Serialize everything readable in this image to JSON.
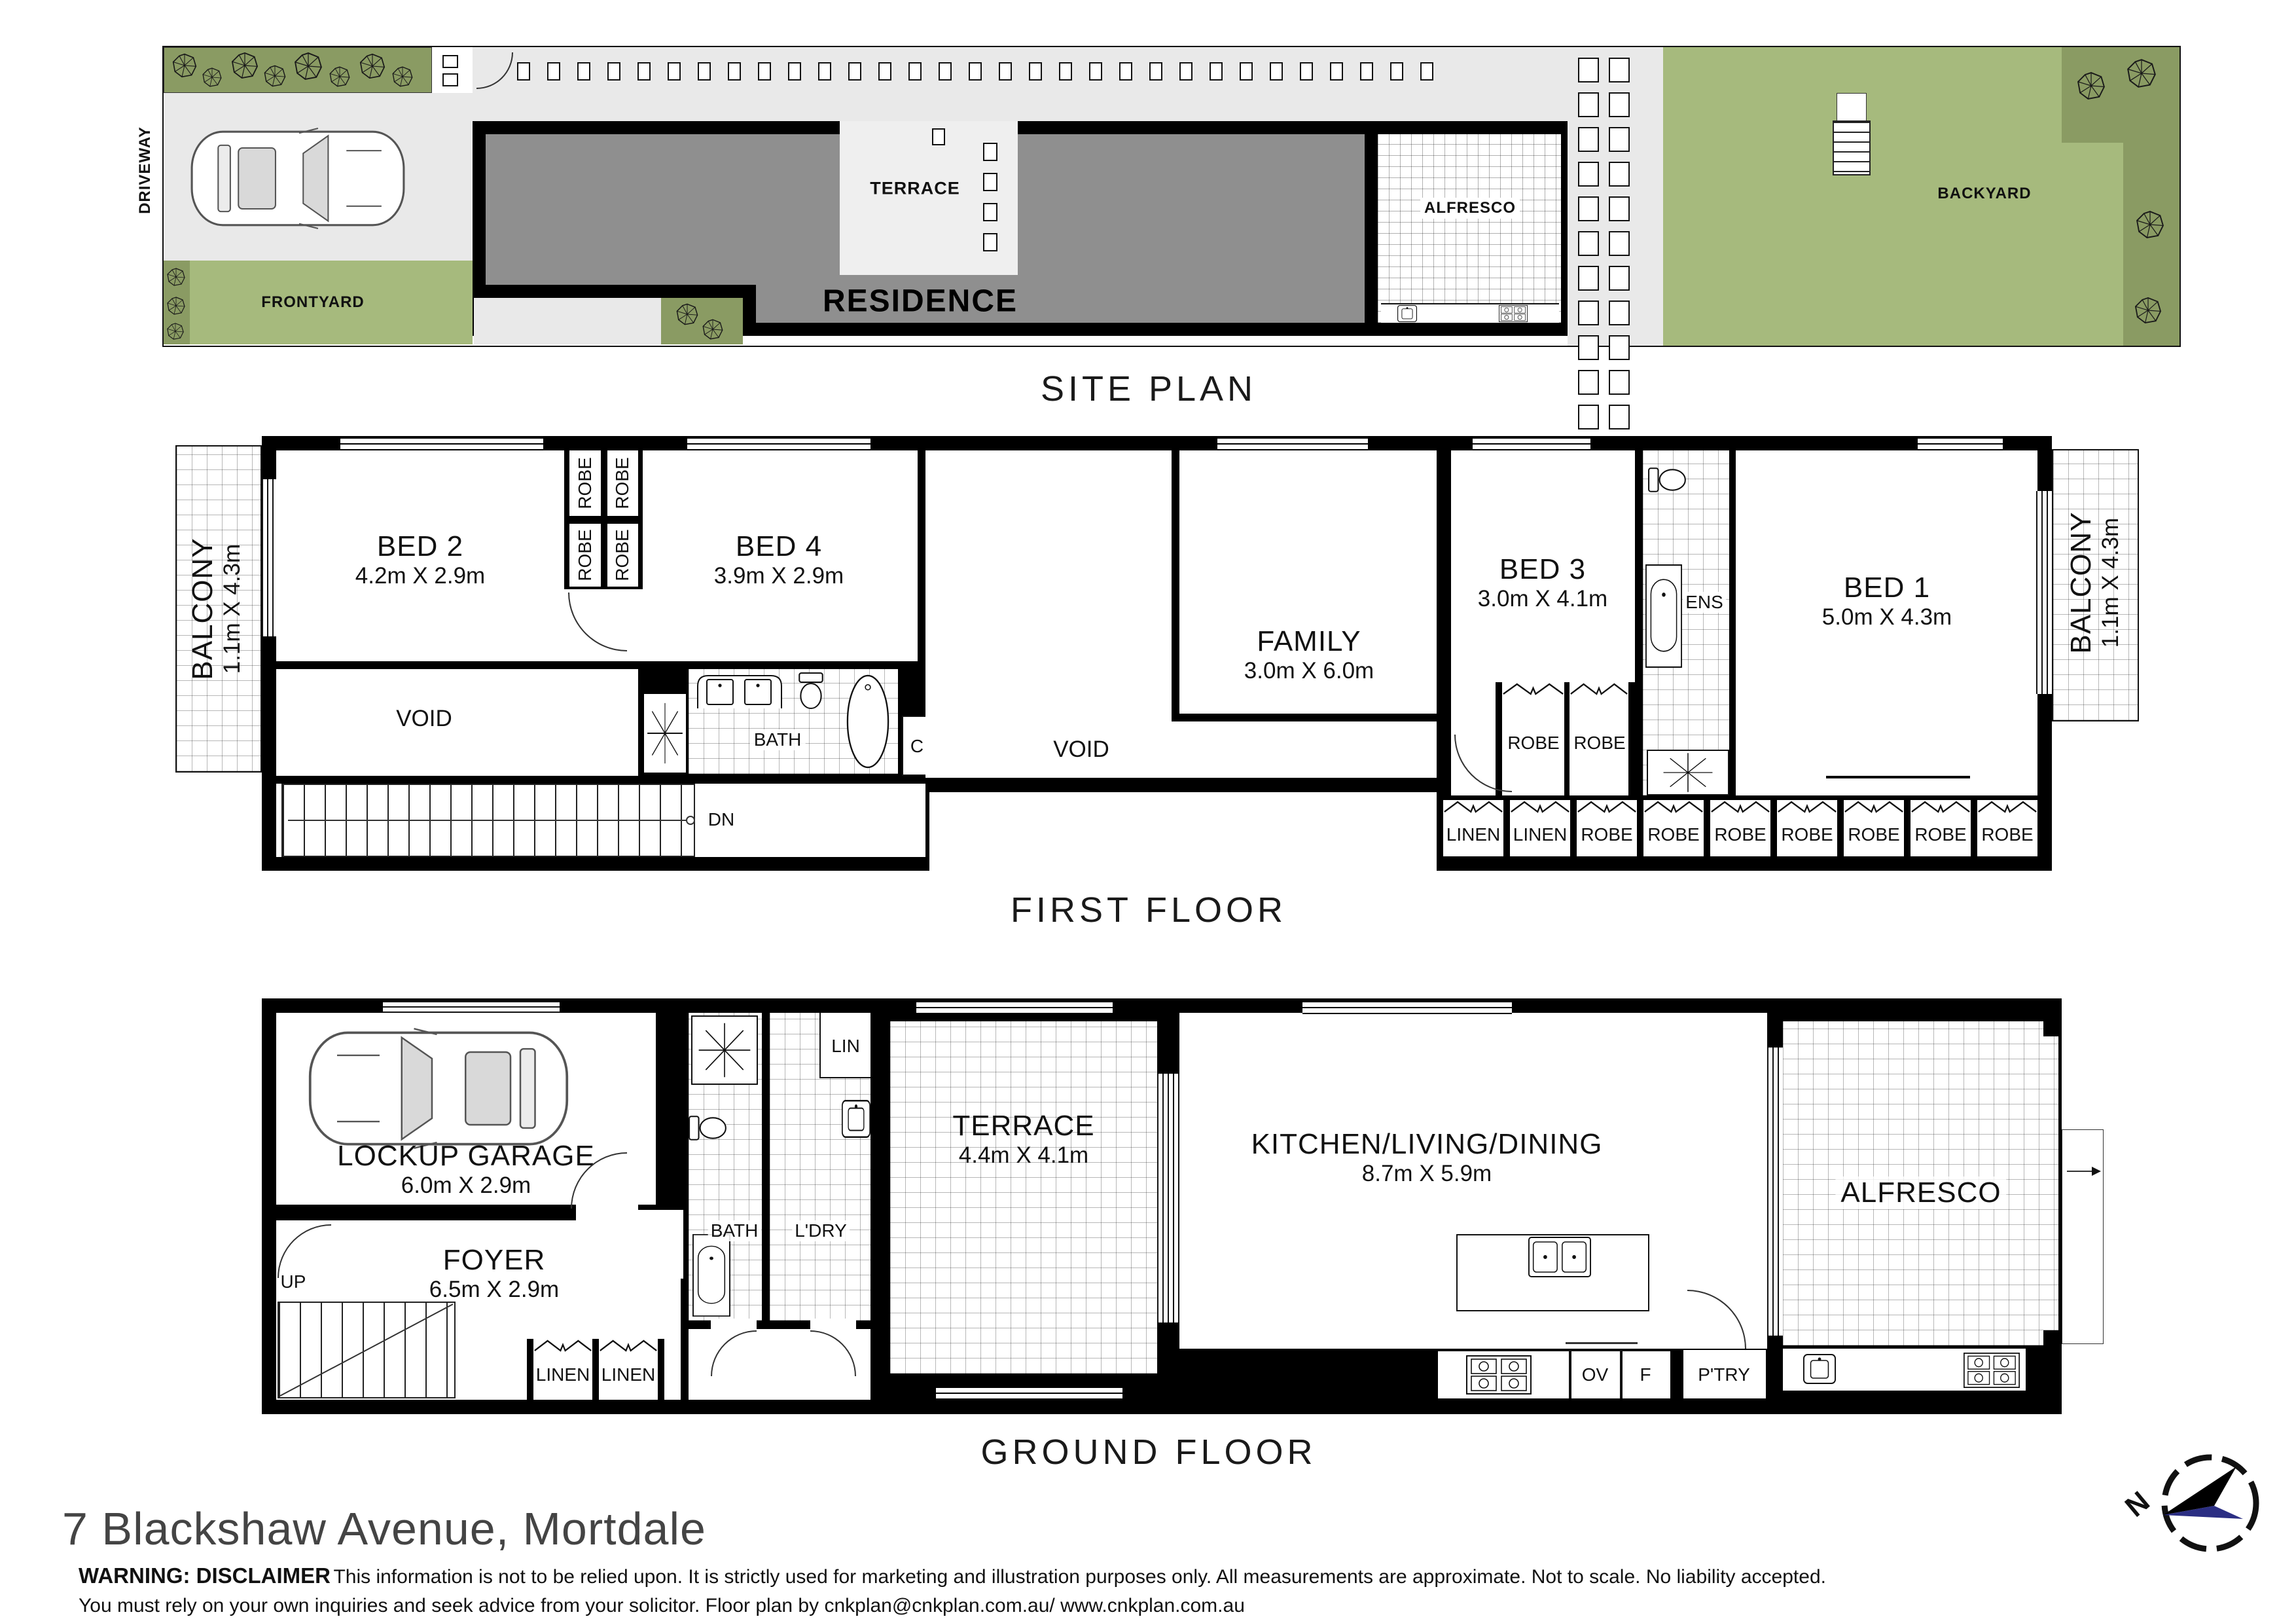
{
  "site_plan": {
    "title": "SITE PLAN",
    "driveway": "DRIVEWAY",
    "frontyard": "FRONTYARD",
    "terrace": "TERRACE",
    "residence": "RESIDENCE",
    "alfresco": "ALFRESCO",
    "backyard": "BACKYARD"
  },
  "first_floor": {
    "title": "FIRST FLOOR",
    "balcony_left": {
      "name": "BALCONY",
      "dims": "1.1m X 4.3m"
    },
    "bed2": {
      "name": "BED 2",
      "dims": "4.2m X 2.9m"
    },
    "robes_top": [
      "ROBE",
      "ROBE",
      "ROBE",
      "ROBE"
    ],
    "bed4": {
      "name": "BED 4",
      "dims": "3.9m X 2.9m"
    },
    "void_left": "VOID",
    "bath": "BATH",
    "dn": "DN",
    "closet": "C",
    "void_mid": "VOID",
    "family": {
      "name": "FAMILY",
      "dims": "3.0m X 6.0m"
    },
    "bed3": {
      "name": "BED 3",
      "dims": "3.0m X 4.1m"
    },
    "bed3_robes": [
      "ROBE",
      "ROBE"
    ],
    "ens": "ENS",
    "bed1": {
      "name": "BED 1",
      "dims": "5.0m X 4.3m"
    },
    "balcony_right": {
      "name": "BALCONY",
      "dims": "1.1m X 4.3m"
    },
    "storage_row": [
      "LINEN",
      "LINEN",
      "ROBE",
      "ROBE",
      "ROBE",
      "ROBE",
      "ROBE",
      "ROBE",
      "ROBE"
    ]
  },
  "ground_floor": {
    "title": "GROUND FLOOR",
    "garage": {
      "name": "LOCKUP GARAGE",
      "dims": "6.0m X 2.9m"
    },
    "foyer": {
      "name": "FOYER",
      "dims": "6.5m X 2.9m"
    },
    "up": "UP",
    "linen_row": [
      "LINEN",
      "LINEN"
    ],
    "st": "ST",
    "bath": "BATH",
    "ldry": "L'DRY",
    "lin": "LIN",
    "terrace": {
      "name": "TERRACE",
      "dims": "4.4m X 4.1m"
    },
    "kitchen": {
      "name": "KITCHEN/LIVING/DINING",
      "dims": "8.7m X 5.9m"
    },
    "ov": "OV",
    "f": "F",
    "ptry": "P'TRY",
    "alfresco": "ALFRESCO"
  },
  "footer": {
    "address": "7 Blackshaw Avenue, Mortdale",
    "warning_bold": "WARNING: DISCLAIMER",
    "warning_rest": "This information is not to be relied upon. It is strictly used for marketing and illustration purposes only. All measurements are approximate. Not to scale. No liability accepted.",
    "warning_line2": "You must rely on your own inquiries and seek advice from your solicitor. Floor plan by cnkplan@cnkplan.com.au/ www.cnkplan.com.au"
  },
  "compass": {
    "north": "N"
  },
  "icons": [
    "tree-icon",
    "car-icon",
    "cooktop-icon",
    "sink-icon",
    "double-sink-icon",
    "toilet-icon",
    "bathtub-icon",
    "basin-icon",
    "vanity-icon",
    "skylight-icon",
    "compass-icon"
  ],
  "colors": {
    "garden_dark": "#8a9b63",
    "lawn": "#a6ba7d",
    "paving": "#e9e9e9",
    "residence_fill": "#8f8f8f",
    "wall": "#000000",
    "compass_navy": "#2b2e83"
  }
}
